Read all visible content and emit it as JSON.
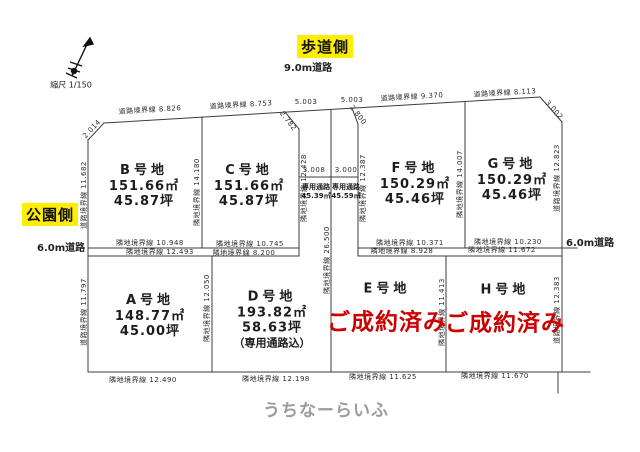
{
  "compass": {
    "scale": "縮尺 1/150"
  },
  "roads": {
    "top": {
      "side": "歩道側",
      "width": "9.0m道路"
    },
    "left": {
      "side": "公園側",
      "width": "6.0m道路"
    },
    "right": {
      "width": "6.0m道路"
    }
  },
  "plots": {
    "b": {
      "name": "B号地",
      "m2": "151.66㎡",
      "tsubo": "45.87坪"
    },
    "c": {
      "name": "C号地",
      "m2": "151.66㎡",
      "tsubo": "45.87坪"
    },
    "f": {
      "name": "F号地",
      "m2": "150.29㎡",
      "tsubo": "45.46坪"
    },
    "g": {
      "name": "G号地",
      "m2": "150.29㎡",
      "tsubo": "45.46坪"
    },
    "a": {
      "name": "A号地",
      "m2": "148.77㎡",
      "tsubo": "45.00坪"
    },
    "d": {
      "name": "D号地",
      "m2": "193.82㎡",
      "tsubo": "58.63坪",
      "note": "（専用通路込）"
    },
    "e": {
      "name": "E号地",
      "status": "ご成約済み"
    },
    "h": {
      "name": "H号地",
      "status": "ご成約済み"
    }
  },
  "passages": {
    "left": {
      "label": "専用通路",
      "area": "45.39㎡"
    },
    "right": {
      "label": "専用通路",
      "area": "45.59㎡"
    }
  },
  "dims": {
    "top": {
      "b": "道路境界線 8.826",
      "c": "道路境界線 8.753",
      "passage_left": "5.003",
      "passage_right": "5.003",
      "f": "道路境界線 9.370",
      "g": "道路境界線 8.113"
    },
    "diagonals": {
      "top_left": "2.014",
      "passage_left": "2.782",
      "passage_right": "2.800",
      "top_right": "3.002"
    },
    "middle_upper": {
      "b": "隣地境界線 10.948",
      "c": "隣地境界線 10.745",
      "f": "隣地境界線 10.371",
      "g": "隣地境界線 10.230"
    },
    "middle_lower": {
      "a": "隣地境界線 12.493",
      "d": "隣地境界線 8.200",
      "e": "隣地境界線 8.928",
      "h": "隣地境界線 11.672"
    },
    "bottom": {
      "a": "隣地境界線 12.490",
      "d": "隣地境界線 12.198",
      "e": "隣地境界線 11.625",
      "h": "隣地境界線 11.670"
    },
    "vertical": {
      "left_top": "道路境界線 11.682",
      "left_bottom": "道路境界線 11.797",
      "b_right": "隣地境界線 14.180",
      "passage_outer_left": "隣地境界線 12.428",
      "passage_center": "隣地境界線 26.500",
      "passage_outer_right": "隣地境界線 12.387",
      "f_right": "隣地境界線 14.007",
      "right_top": "道路境界線 12.823",
      "a_right": "隣地境界線 12.050",
      "eh_divider": "隣地境界線 11.413",
      "right_bottom": "道路境界線 12.383"
    },
    "passage_width_left": "3.008",
    "passage_width_right": "3.000"
  },
  "colors": {
    "sold_red": "#cc0000",
    "highlight_yellow": "#ffee00"
  },
  "watermark": "うちなーらいふ"
}
